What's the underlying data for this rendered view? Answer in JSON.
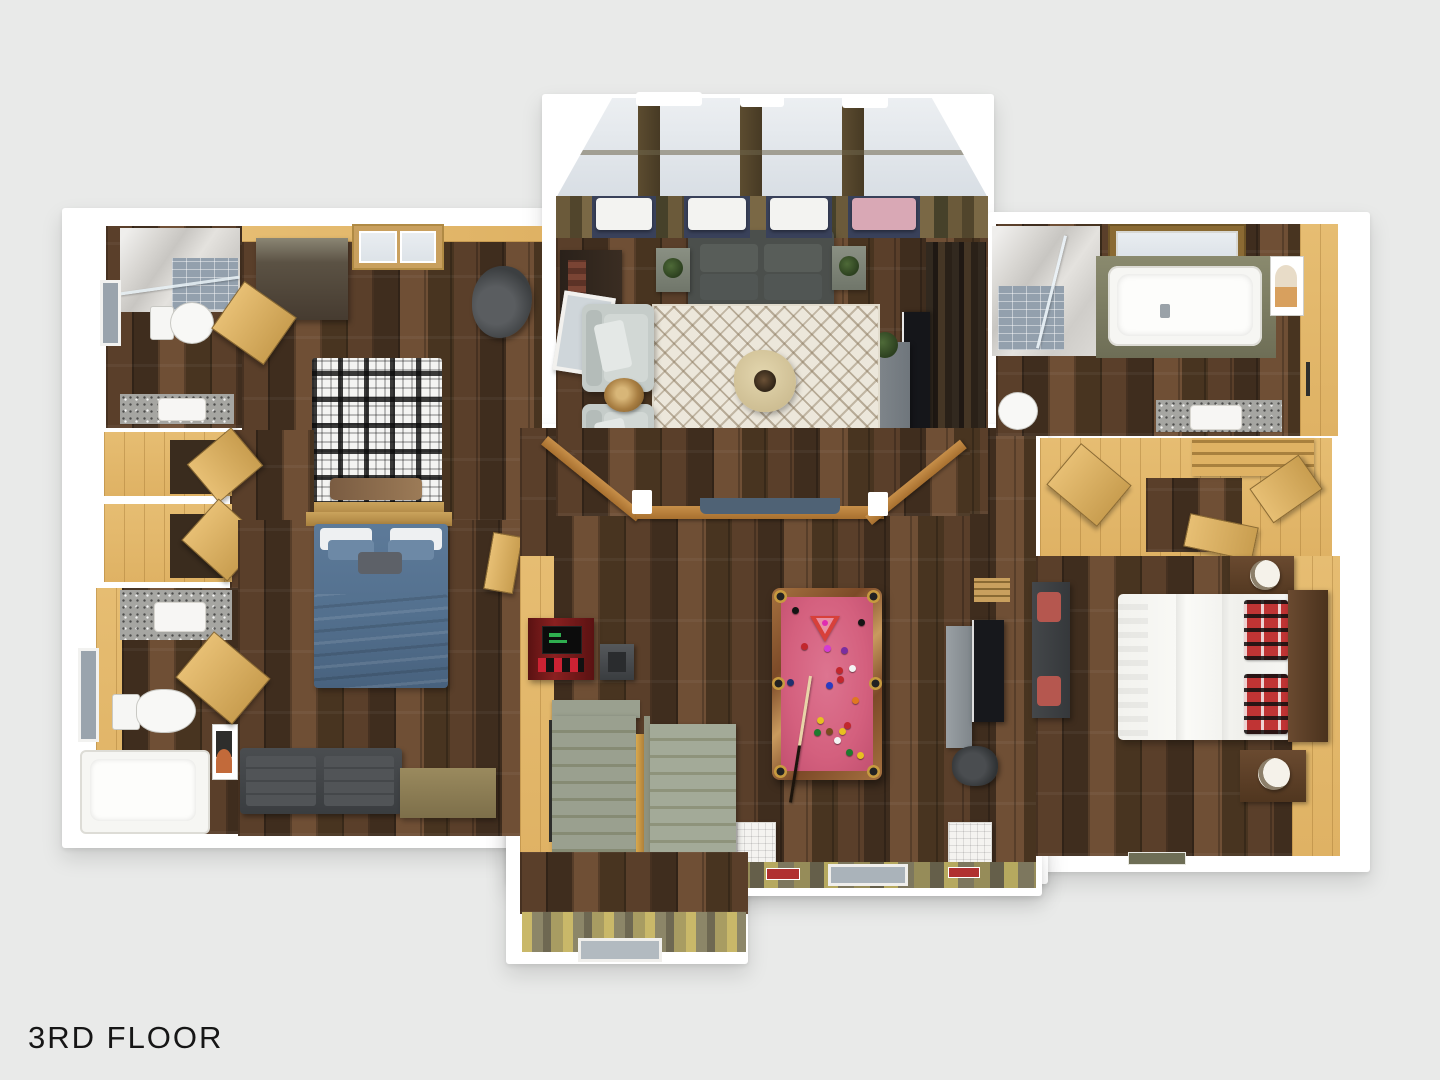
{
  "title": "3D Floor Plan — Third Floor",
  "floor_label": "3RD FLOOR",
  "palette": {
    "bg": "#e9eae9",
    "wall": "#ffffff",
    "pine": "#dfb264",
    "tan": "#c9a05e",
    "woodA": "#5a3f2a",
    "woodB": "#3f2d1e",
    "woodC": "#6f4f35",
    "woodD": "#483420",
    "glass": "#dde3e8",
    "granite": "#a6a6a2",
    "rug": "#ece7db",
    "felt": "#d4607e",
    "frame": "#7c4a28",
    "gold": "#c79a3f",
    "sofa": "#4b4f4c",
    "chair": "#c5ccc9",
    "navy": "#5d7185",
    "bluebed": "#5d7a99",
    "steps": "#9aa08f",
    "stepsDark": "#868b74",
    "red": "#b03030",
    "charcoal": "#3c3f41",
    "pinkCushion": "#d9a8b5"
  },
  "rooms": [
    {
      "name": "bathroom-top-left",
      "items": [
        "shower-marble",
        "toilet",
        "vanity-sink",
        "window"
      ]
    },
    {
      "name": "bedroom-plaid",
      "items": [
        "plaid-bed",
        "wardrobe",
        "skylight-window",
        "armchair-dark",
        "open-door"
      ]
    },
    {
      "name": "hallway-closets",
      "items": [
        "closet",
        "closet",
        "open-door",
        "open-door"
      ]
    },
    {
      "name": "bathroom-lower-left",
      "items": [
        "vanity-sink",
        "toilet",
        "bathtub",
        "window"
      ]
    },
    {
      "name": "bedroom-blue",
      "items": [
        "blue-bed",
        "futon-sofa",
        "dresser",
        "wall-art",
        "open-door"
      ]
    },
    {
      "name": "living-room",
      "items": [
        "skylight-roof",
        "window-seats",
        "gray-sofa",
        "side-tables",
        "chevron-rug",
        "coffee-table",
        "armchairs",
        "stump-tables",
        "navy-sofa",
        "media-console",
        "tv",
        "railing",
        "leaning-mirror",
        "fireplace"
      ]
    },
    {
      "name": "game-room",
      "items": [
        "pool-table",
        "pool-cue",
        "arcade-machine",
        "stool",
        "staircase-down",
        "staircase-wide",
        "desk-monitor",
        "office-chair",
        "ottoman-cube",
        "ottoman-cube",
        "doormat",
        "doormat",
        "deck-balcony"
      ]
    },
    {
      "name": "bathroom-right",
      "items": [
        "shower-marble",
        "bathtub",
        "skylight-window",
        "toilet",
        "vanity-sink",
        "wall-art"
      ]
    },
    {
      "name": "closet-hall-right",
      "items": [
        "shelf-closet",
        "open-door",
        "open-door"
      ]
    },
    {
      "name": "bedroom-white",
      "items": [
        "white-bed",
        "plaid-pillows",
        "headboard",
        "nightstand",
        "nightstand",
        "lamp",
        "lamp",
        "bench-sofa",
        "doormat"
      ]
    }
  ],
  "pool_balls": [
    {
      "x": 792,
      "y": 607,
      "c": "#141414"
    },
    {
      "x": 827,
      "y": 617,
      "c": "#141414"
    },
    {
      "x": 858,
      "y": 619,
      "c": "#141414"
    },
    {
      "x": 801,
      "y": 643,
      "c": "#c2272d"
    },
    {
      "x": 824,
      "y": 645,
      "c": "#d43bd4"
    },
    {
      "x": 841,
      "y": 647,
      "c": "#7a2ea0"
    },
    {
      "x": 836,
      "y": 667,
      "c": "#c2272d"
    },
    {
      "x": 849,
      "y": 665,
      "c": "#f4f4f4"
    },
    {
      "x": 837,
      "y": 676,
      "c": "#c2272d"
    },
    {
      "x": 826,
      "y": 682,
      "c": "#2a3bc2"
    },
    {
      "x": 787,
      "y": 679,
      "c": "#20306e"
    },
    {
      "x": 852,
      "y": 697,
      "c": "#e07820"
    },
    {
      "x": 817,
      "y": 717,
      "c": "#e8c020"
    },
    {
      "x": 844,
      "y": 722,
      "c": "#c2272d"
    },
    {
      "x": 814,
      "y": 729,
      "c": "#1e7a2e"
    },
    {
      "x": 826,
      "y": 728,
      "c": "#7a4a20"
    },
    {
      "x": 839,
      "y": 728,
      "c": "#e8c020"
    },
    {
      "x": 834,
      "y": 737,
      "c": "#f4f4f4"
    },
    {
      "x": 846,
      "y": 749,
      "c": "#1e7a2e"
    },
    {
      "x": 857,
      "y": 752,
      "c": "#e8c020"
    }
  ],
  "window_seats": [
    {
      "x": 596,
      "w": 56,
      "color": "#f3f3f1"
    },
    {
      "x": 688,
      "w": 58,
      "color": "#f3f3f1"
    },
    {
      "x": 770,
      "w": 58,
      "color": "#f3f3f1"
    },
    {
      "x": 852,
      "w": 64,
      "color": "#d9a8b5"
    }
  ]
}
